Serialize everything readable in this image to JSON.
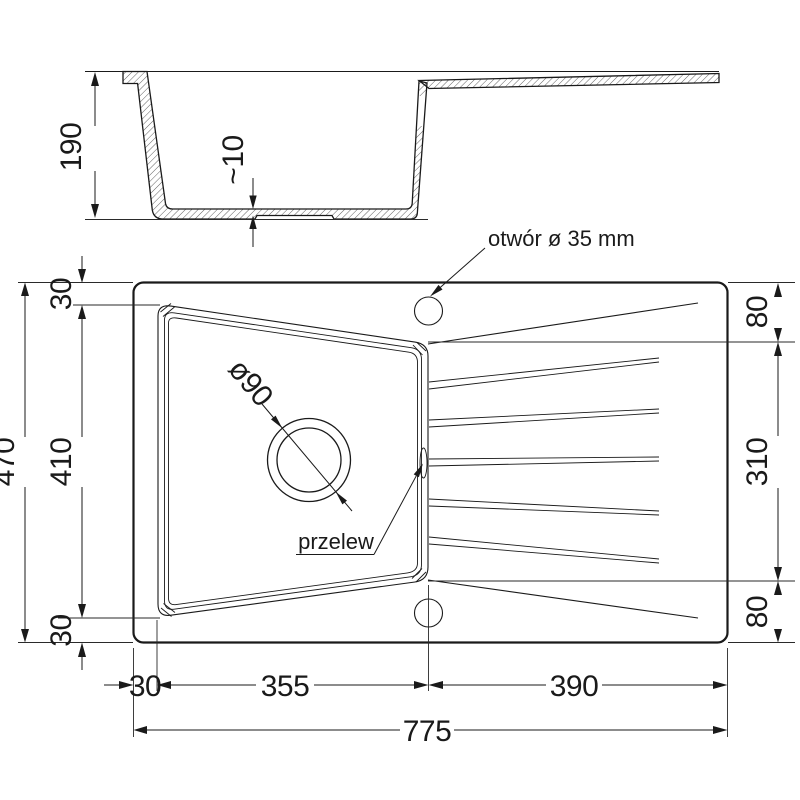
{
  "drawing": {
    "section": {
      "depth": "190",
      "bottom_thickness": "~10"
    },
    "plan": {
      "tap_hole_label": "otwór ø 35 mm",
      "overflow_label": "przelew",
      "drain_label": "ø90",
      "height_total": "470",
      "height_basin": "410",
      "rim_top": "30",
      "rim_bottom": "30",
      "right_top": "80",
      "right_drainer": "310",
      "right_bottom": "80",
      "rim_left": "30",
      "basin_width": "355",
      "drainer_width": "390",
      "width_total": "775"
    },
    "colors": {
      "line": "#1a1a1a",
      "background": "#ffffff"
    }
  }
}
